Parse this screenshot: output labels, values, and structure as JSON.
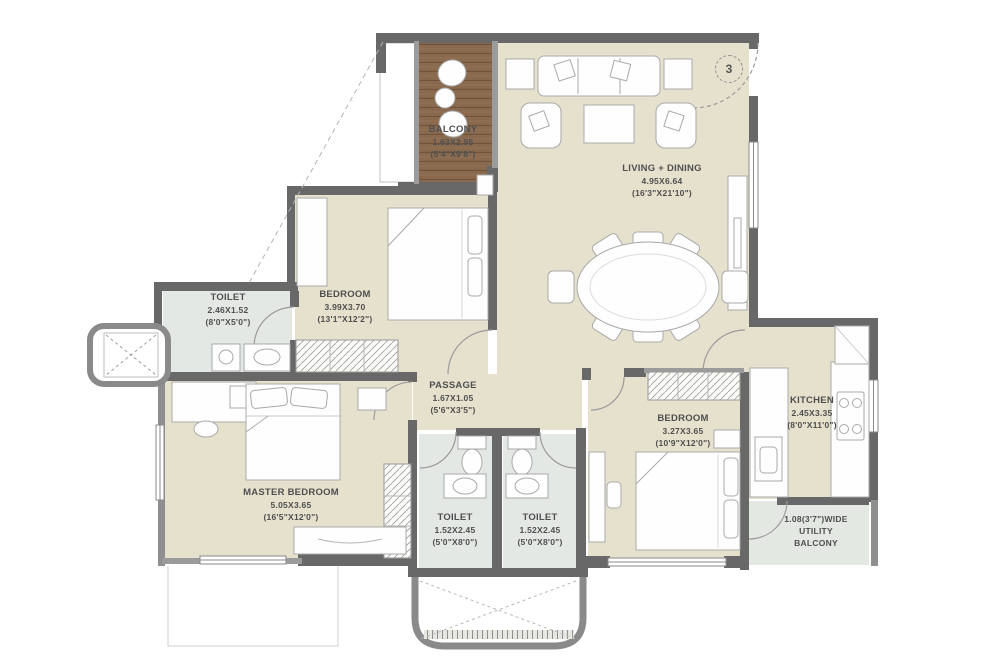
{
  "plan": {
    "unit_circle": "3",
    "rooms": {
      "balcony": {
        "name": "BALCONY",
        "dim_m": "1.63X2.95",
        "dim_ft": "(5'4\"X9'8\")"
      },
      "living_dining": {
        "name": "LIVING + DINING",
        "dim_m": "4.95X6.64",
        "dim_ft": "(16'3\"X21'10\")"
      },
      "toilet_top": {
        "name": "TOILET",
        "dim_m": "2.46X1.52",
        "dim_ft": "(8'0\"X5'0\")"
      },
      "bedroom_top": {
        "name": "BEDROOM",
        "dim_m": "3.99X3.70",
        "dim_ft": "(13'1\"X12'2\")"
      },
      "passage": {
        "name": "PASSAGE",
        "dim_m": "1.67X1.05",
        "dim_ft": "(5'6\"X3'5\")"
      },
      "master_bedroom": {
        "name": "MASTER BEDROOM",
        "dim_m": "5.05X3.65",
        "dim_ft": "(16'5\"X12'0\")"
      },
      "toilet_left": {
        "name": "TOILET",
        "dim_m": "1.52X2.45",
        "dim_ft": "(5'0\"X8'0\")"
      },
      "toilet_right": {
        "name": "TOILET",
        "dim_m": "1.52X2.45",
        "dim_ft": "(5'0\"X8'0\")"
      },
      "bedroom_right": {
        "name": "BEDROOM",
        "dim_m": "3.27X3.65",
        "dim_ft": "(10'9\"X12'0\")"
      },
      "kitchen": {
        "name": "KITCHEN",
        "dim_m": "2.45X3.35",
        "dim_ft": "(8'0\"X11'0\")"
      },
      "utility_balcony": {
        "line1": "1.08(3'7\")WIDE",
        "line2": "UTILITY",
        "line3": "BALCONY"
      }
    },
    "colors": {
      "floor": "#e6e1cd",
      "wet_floor": "#e4e8e5",
      "utility_floor": "#e3e8e2",
      "wall": "#686868",
      "wood": "#8a6a4e",
      "text": "#4f4f4f"
    }
  }
}
